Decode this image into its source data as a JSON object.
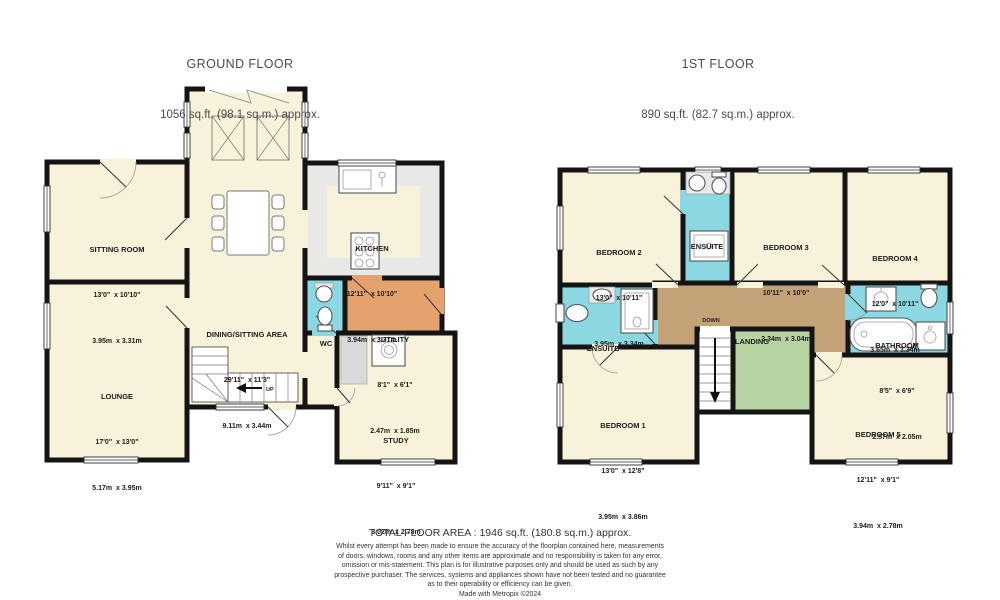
{
  "colors": {
    "room_cream": "#f7f2d9",
    "wet_room_cyan": "#8bd7e2",
    "utility_orange": "#e4a36c",
    "landing_tan": "#c3a277",
    "stairwell_green": "#b7d3a2",
    "kitchen_gray": "#e8e8e6",
    "wall_black": "#141414"
  },
  "ground_floor": {
    "title": "GROUND FLOOR",
    "area": "1056 sq.ft. (98.1 sq.m.) approx.",
    "stair_label": "UP",
    "rooms": {
      "sitting_room": {
        "name": "SITTING ROOM",
        "imperial": "13'0\"  x 10'10\"",
        "metric": "3.95m  x 3.31m"
      },
      "lounge": {
        "name": "LOUNGE",
        "imperial": "17'0\"  x 13'0\"",
        "metric": "5.17m  x 3.95m"
      },
      "dining": {
        "name": "DINING/SITTING AREA",
        "imperial": "29'11\"  x 11'3\"",
        "metric": "9.11m  x 3.44m"
      },
      "kitchen": {
        "name": "KITCHEN",
        "imperial": "12'11\"  x 10'10\"",
        "metric": "3.94m  x 3.31m"
      },
      "wc": {
        "name": "WC"
      },
      "utility": {
        "name": "UTILITY",
        "imperial": "8'1\"  x 6'1\"",
        "metric": "2.47m  x 1.85m"
      },
      "study": {
        "name": "STUDY",
        "imperial": "9'11\"  x 9'1\"",
        "metric": "3.02m  x 2.78m"
      }
    }
  },
  "first_floor": {
    "title": "1ST FLOOR",
    "area": "890 sq.ft. (82.7 sq.m.) approx.",
    "stair_label": "DOWN",
    "rooms": {
      "bedroom2": {
        "name": "BEDROOM 2",
        "imperial": "13'0\"  x 10'11\"",
        "metric": "3.95m  x 3.34m"
      },
      "ensuite_top": {
        "name": "ENSUITE"
      },
      "bedroom3": {
        "name": "BEDROOM 3",
        "imperial": "10'11\"  x 10'0\"",
        "metric": "3.34m  x 3.04m"
      },
      "bedroom4": {
        "name": "BEDROOM 4",
        "imperial": "12'0\"  x 10'11\"",
        "metric": "3.65m  x 3.34m"
      },
      "ensuite_left": {
        "name": "ENSUITE"
      },
      "landing": {
        "name": "LANDING"
      },
      "bathroom": {
        "name": "BATHROOM",
        "imperial": "8'5\"  x 6'9\"",
        "metric": "2.57m  x 2.05m"
      },
      "bedroom1": {
        "name": "BEDROOM 1",
        "imperial": "13'0\"  x 12'8\"",
        "metric": "3.95m  x 3.86m"
      },
      "bedroom5": {
        "name": "BEDROOM 5",
        "imperial": "12'11\"  x 9'1\"",
        "metric": "3.94m  x 2.78m"
      }
    }
  },
  "footer": {
    "total": "TOTAL FLOOR AREA : 1946 sq.ft. (180.8 sq.m.) approx.",
    "disclaimer": [
      "Whilst every attempt has been made to ensure the accuracy of the floorplan contained here, measurements",
      "of doors, windows, rooms and any other items are approximate and no responsibility is taken for any error,",
      "omission or mis-statement. This plan is for illustrative purposes only and should be used as such by any",
      "prospective purchaser. The services, systems and appliances shown have not been tested and no guarantee",
      "as to their operability or efficiency can be given."
    ],
    "credit": "Made with Metropix ©2024"
  }
}
